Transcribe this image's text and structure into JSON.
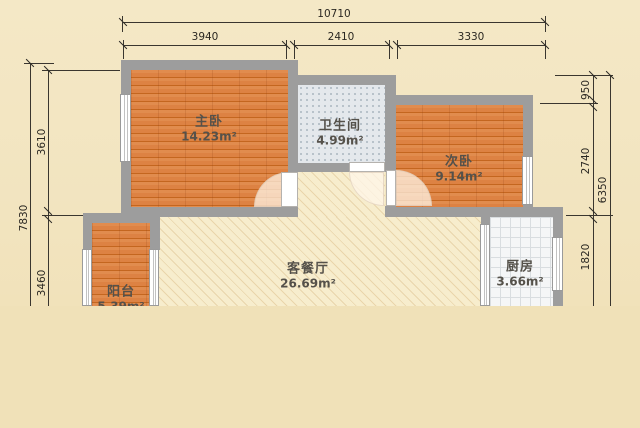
{
  "title": "apartment-floor-plan",
  "rooms": [
    {
      "name": "主卧",
      "area": "14.23m²"
    },
    {
      "name": "卫生间",
      "area": "4.99m²"
    },
    {
      "name": "次卧",
      "area": "9.14m²"
    },
    {
      "name": "客餐厅",
      "area": "26.69m²"
    },
    {
      "name": "阳台",
      "area": "5.39m²"
    },
    {
      "name": "厨房",
      "area": "3.66m²"
    }
  ],
  "dimensions": {
    "top": {
      "total": "10710",
      "segments": [
        "3940",
        "2410",
        "3330"
      ]
    },
    "left": {
      "total": "7830",
      "segments": [
        "3610",
        "3460"
      ]
    },
    "right": {
      "total": "6350",
      "segments": [
        "950",
        "2740",
        "1820"
      ]
    }
  },
  "colors": {
    "wall": "#9d9d9d",
    "wood_floor": "#dd8243",
    "bath_tile": "#e4e8ec",
    "kitchen_tile": "#f5f6f7",
    "living_floor": "#f7edcd",
    "background": "#f0e1b8",
    "dimension_line": "#3a362f"
  }
}
